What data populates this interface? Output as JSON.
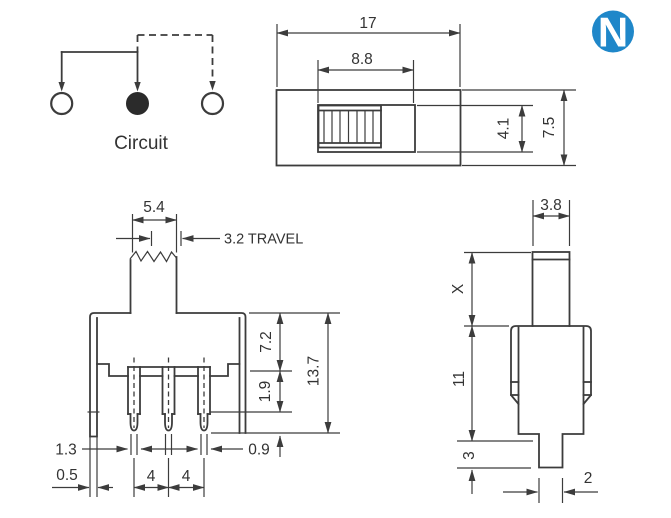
{
  "labels": {
    "circuit": "Circuit",
    "travel": "3.2 TRAVEL"
  },
  "logo": {
    "letter": "N",
    "color": "#1f87c9"
  },
  "top_view": {
    "overall_width": "17",
    "slot_width": "8.8",
    "slot_height": "4.1",
    "overall_height": "7.5"
  },
  "front_view": {
    "knob_width": "5.4",
    "body_height": "7.2",
    "shoulder_height": "1.9",
    "total_height": "13.7",
    "pin_width": "1.3",
    "foot_width": "0.5",
    "pitch_left": "4",
    "pitch_right": "4",
    "pin_thickness": "0.9"
  },
  "side_view": {
    "stem_width": "3.8",
    "stem_height": "X",
    "body_height": "11",
    "pin_length": "3",
    "pin_width": "2"
  }
}
